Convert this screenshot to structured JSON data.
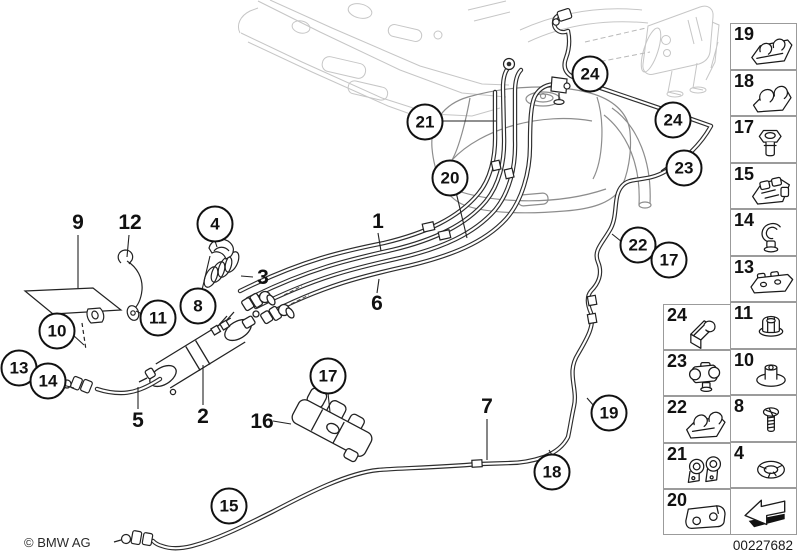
{
  "window": {
    "width": 799,
    "height": 559
  },
  "footer": {
    "copyright": "© BMW AG",
    "diagram_number": "00227682"
  },
  "colors": {
    "background": "#ffffff",
    "line_dark": "#2e2e2e",
    "line_mid": "#8d8d8d",
    "line_light": "#c6c6c6",
    "legend_border": "#9b9b9b",
    "text": "#111111"
  },
  "diagram": {
    "circled_callouts": [
      {
        "label": "24",
        "x": 590,
        "y": 74
      },
      {
        "label": "21",
        "x": 425,
        "y": 122
      },
      {
        "label": "24",
        "x": 673,
        "y": 120
      },
      {
        "label": "23",
        "x": 684,
        "y": 168
      },
      {
        "label": "20",
        "x": 450,
        "y": 178
      },
      {
        "label": "4",
        "x": 215,
        "y": 224
      },
      {
        "label": "22",
        "x": 638,
        "y": 245
      },
      {
        "label": "17",
        "x": 669,
        "y": 260
      },
      {
        "label": "8",
        "x": 198,
        "y": 306
      },
      {
        "label": "11",
        "x": 158,
        "y": 318
      },
      {
        "label": "10",
        "x": 57,
        "y": 331
      },
      {
        "label": "13",
        "x": 19,
        "y": 368
      },
      {
        "label": "14",
        "x": 48,
        "y": 381
      },
      {
        "label": "17",
        "x": 328,
        "y": 376
      },
      {
        "label": "19",
        "x": 609,
        "y": 413
      },
      {
        "label": "18",
        "x": 552,
        "y": 472
      },
      {
        "label": "15",
        "x": 229,
        "y": 506
      }
    ],
    "plain_callouts": [
      {
        "label": "9",
        "x": 78,
        "y": 223
      },
      {
        "label": "12",
        "x": 130,
        "y": 223
      },
      {
        "label": "1",
        "x": 378,
        "y": 222
      },
      {
        "label": "3",
        "x": 263,
        "y": 278
      },
      {
        "label": "6",
        "x": 377,
        "y": 304
      },
      {
        "label": "5",
        "x": 138,
        "y": 421
      },
      {
        "label": "2",
        "x": 203,
        "y": 417
      },
      {
        "label": "16",
        "x": 262,
        "y": 422
      },
      {
        "label": "7",
        "x": 487,
        "y": 407
      }
    ]
  },
  "legend": {
    "right_column": {
      "items": [
        {
          "label": "19",
          "icon": "clamp-rail-icon"
        },
        {
          "label": "18",
          "icon": "clamp-double-icon"
        },
        {
          "label": "17",
          "icon": "screw-plug-icon"
        },
        {
          "label": "15",
          "icon": "multi-holder-icon"
        },
        {
          "label": "14",
          "icon": "c-clip-icon"
        },
        {
          "label": "13",
          "icon": "long-rail-icon"
        },
        {
          "label": "11",
          "icon": "cap-nut-icon"
        },
        {
          "label": "10",
          "icon": "washer-nut-icon"
        },
        {
          "label": "8",
          "icon": "screw-icon"
        },
        {
          "label": "4",
          "icon": "lock-ring-icon"
        }
      ],
      "footer_icon": "nav-arrow-icon"
    },
    "inner_column": {
      "items": [
        {
          "label": "24",
          "icon": "angle-holder-icon"
        },
        {
          "label": "23",
          "icon": "round-clamp-icon"
        },
        {
          "label": "22",
          "icon": "open-clamp-icon"
        },
        {
          "label": "21",
          "icon": "double-clip-icon"
        },
        {
          "label": "20",
          "icon": "rubber-block-icon"
        }
      ]
    }
  }
}
